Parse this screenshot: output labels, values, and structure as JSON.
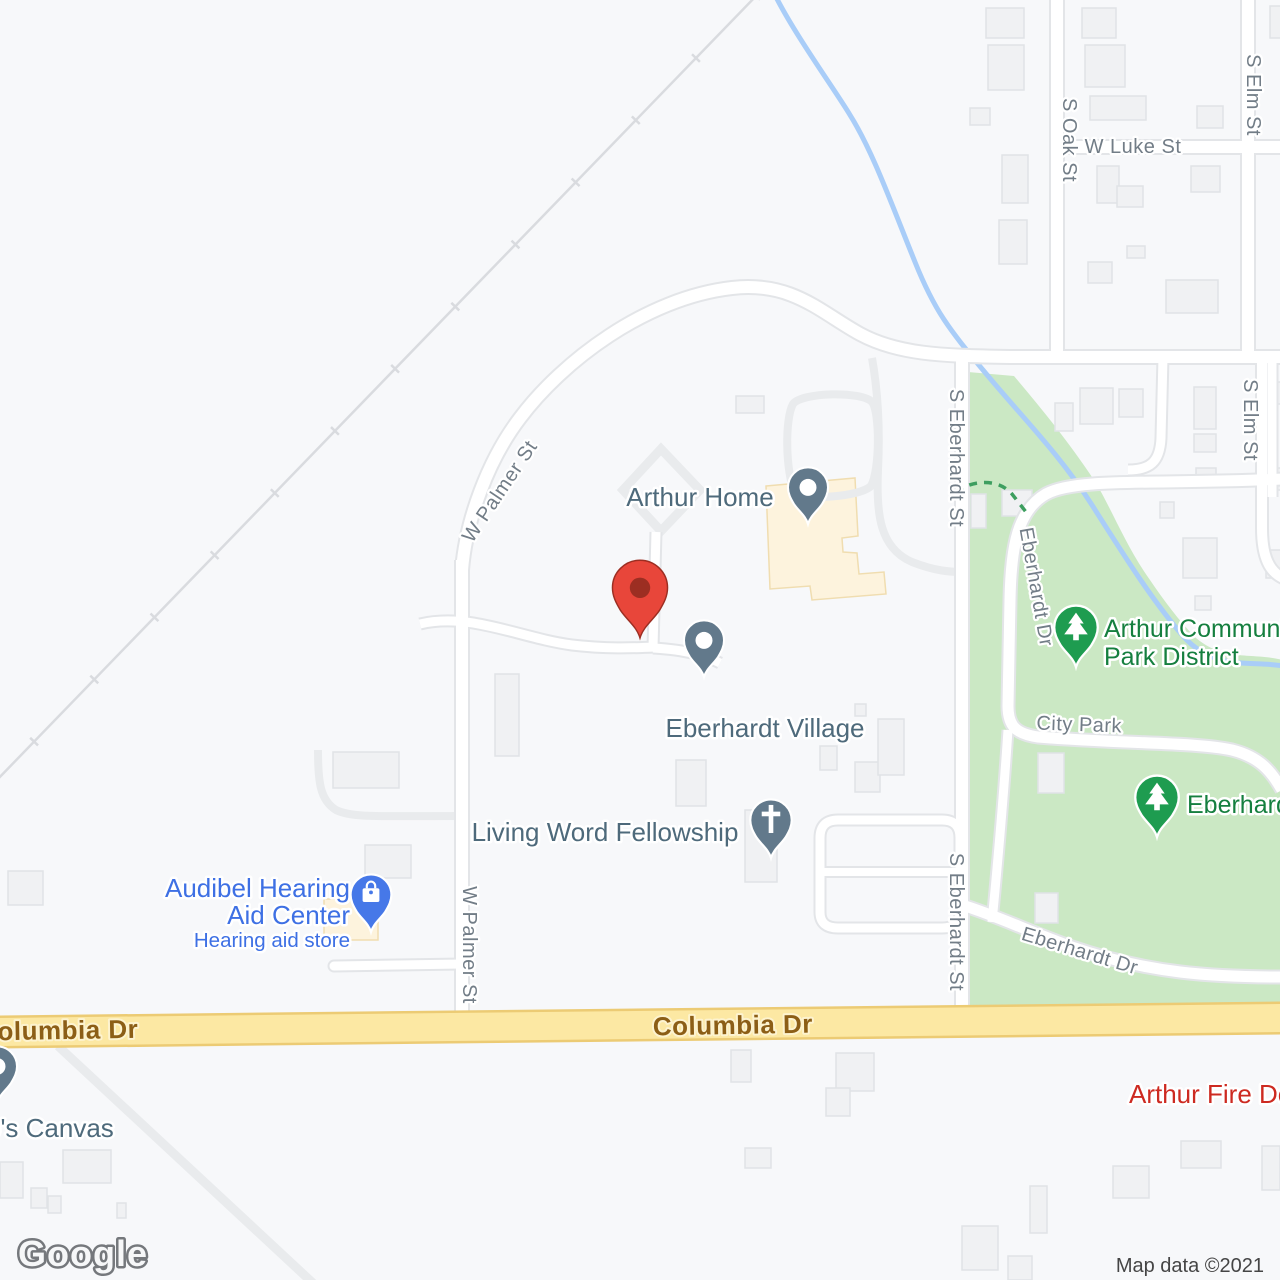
{
  "app": "google-maps-static-view",
  "attribution": {
    "logo": "Google",
    "map_data": "Map data ©2021"
  },
  "colors": {
    "background": "#f7f8fa",
    "road_fill": "#ffffff",
    "road_casing": "#e3e5e8",
    "driveway": "#e9ebed",
    "park": "#cbe8c4",
    "water": "#a9cdf8",
    "railroad": "#d9dbdf",
    "building_fill": "#f0f1f3",
    "building_stroke": "#e0e3e6",
    "commercial_building": "#fdf3dd",
    "commercial_building_stroke": "#f0ddb0",
    "yellow_road_fill": "#fce8a3",
    "yellow_road_casing": "#eccb74",
    "street_label": "#727d87",
    "road_label_brown": "#8c5e16",
    "poi_slate": "#4e6a7b",
    "poi_blue": "#3e70e4",
    "poi_green": "#157f3f",
    "poi_red": "#cd2a21",
    "pin_slate": "#62798b",
    "pin_blue": "#4678e8",
    "pin_green": "#1e9c50",
    "marker_red": "#e8463a",
    "marker_red_dark": "#9c2e22",
    "attribution_text": "#454545",
    "trail_green": "#3d9e5f"
  },
  "street_labels": [
    {
      "text": "W Luke St",
      "x": 1133,
      "y": 153,
      "r": 0,
      "size": 20
    },
    {
      "text": "S Oak St",
      "x": 1063,
      "y": 140,
      "r": 90,
      "size": 20
    },
    {
      "text": "S Elm St",
      "x": 1247,
      "y": 95,
      "r": 90,
      "size": 20
    },
    {
      "text": "S Elm St",
      "x": 1244,
      "y": 420,
      "r": 90,
      "size": 20
    },
    {
      "text": "W Palmer St",
      "x": 505,
      "y": 495,
      "r": -56,
      "size": 20
    },
    {
      "text": "W Palmer St",
      "x": 463,
      "y": 945,
      "r": 90,
      "size": 20
    },
    {
      "text": "S Eberhardt St",
      "x": 950,
      "y": 458,
      "r": 90,
      "size": 20
    },
    {
      "text": "S Eberhardt St",
      "x": 950,
      "y": 922,
      "r": 90,
      "size": 20
    },
    {
      "text": "Eberhardt Dr",
      "x": 1030,
      "y": 588,
      "r": 80,
      "size": 20
    },
    {
      "text": "City Park",
      "x": 1079,
      "y": 731,
      "r": 2,
      "size": 20
    },
    {
      "text": "Eberhardt Dr",
      "x": 1078,
      "y": 957,
      "r": 17,
      "size": 20
    },
    {
      "text": "Columbia Dr",
      "x": 733,
      "y": 1034,
      "r": -1,
      "size": 26,
      "cls": "main-road-label"
    },
    {
      "text": "olumbia Dr",
      "x": 68,
      "y": 1039,
      "r": -1,
      "size": 26,
      "cls": "main-road-label"
    }
  ],
  "pois": [
    {
      "id": "arthur-home",
      "anchor": "middle",
      "color": "poi-slate",
      "lines": [
        {
          "text": "Arthur Home",
          "size": 26,
          "x": 700,
          "y": 506
        }
      ],
      "pin": {
        "x": 808,
        "y": 524,
        "type": "dot",
        "color_key": "pin_slate",
        "scale": 1.18
      }
    },
    {
      "id": "eberhardt-village",
      "anchor": "middle",
      "color": "poi-slate",
      "lines": [
        {
          "text": "Eberhardt Village",
          "size": 26,
          "x": 765,
          "y": 737
        }
      ],
      "pin": {
        "x": 704,
        "y": 677,
        "type": "dot",
        "color_key": "pin_slate",
        "scale": 1.18
      }
    },
    {
      "id": "living-word-fellowship",
      "anchor": "middle",
      "color": "poi-slate",
      "lines": [
        {
          "text": "Living Word Fellowship",
          "size": 26,
          "x": 605,
          "y": 841
        }
      ],
      "pin": {
        "x": 771,
        "y": 858,
        "type": "cross",
        "color_key": "pin_slate",
        "scale": 1.22
      }
    },
    {
      "id": "audibel-hearing-aid-center",
      "anchor": "end",
      "color": "poi-blue",
      "lines": [
        {
          "text": "Audibel Hearing",
          "size": 26,
          "x": 350,
          "y": 897
        },
        {
          "text": "Aid Center",
          "size": 26,
          "x": 350,
          "y": 924
        },
        {
          "text": "Hearing aid store",
          "size": 20.5,
          "x": 350,
          "y": 947
        }
      ],
      "pin": {
        "x": 371,
        "y": 932,
        "type": "bag",
        "color_key": "pin_blue",
        "scale": 1.2
      }
    },
    {
      "id": "arthur-community-park-district",
      "anchor": "start",
      "color": "poi-green",
      "lines": [
        {
          "text": "Arthur Community",
          "size": 25,
          "x": 1104,
          "y": 637
        },
        {
          "text": "Park District",
          "size": 25,
          "x": 1104,
          "y": 665
        }
      ],
      "pin": {
        "x": 1076,
        "y": 667,
        "type": "tree",
        "color_key": "pin_green",
        "scale": 1.28
      }
    },
    {
      "id": "eberhardt-park",
      "anchor": "start",
      "color": "poi-green",
      "lines": [
        {
          "text": "Eberhardt",
          "size": 25,
          "x": 1187,
          "y": 813
        }
      ],
      "pin": {
        "x": 1157,
        "y": 837,
        "type": "tree",
        "color_key": "pin_green",
        "scale": 1.28
      }
    },
    {
      "id": "canvas-store",
      "anchor": "start",
      "color": "poi-slate",
      "lines": [
        {
          "text": "o's Canvas",
          "size": 26,
          "x": -14,
          "y": 1137
        }
      ],
      "pin": {
        "x": -3,
        "y": 1103,
        "type": "dot",
        "color_key": "pin_slate",
        "scale": 1.18
      }
    },
    {
      "id": "arthur-fire-dept",
      "anchor": "start",
      "color": "poi-red",
      "lines": [
        {
          "text": "Arthur Fire Dept",
          "size": 26,
          "x": 1129,
          "y": 1103
        }
      ]
    }
  ],
  "marker": {
    "name": "selected-location-marker",
    "x": 640,
    "y": 638,
    "scale": 1.62
  },
  "buildings": [
    [
      986,
      8,
      38,
      30
    ],
    [
      1082,
      8,
      34,
      30
    ],
    [
      988,
      45,
      36,
      45
    ],
    [
      1085,
      45,
      40,
      42
    ],
    [
      970,
      108,
      20,
      17
    ],
    [
      1090,
      96,
      56,
      24
    ],
    [
      1197,
      106,
      26,
      22
    ],
    [
      1002,
      155,
      26,
      48
    ],
    [
      1097,
      166,
      22,
      37
    ],
    [
      1117,
      186,
      26,
      21
    ],
    [
      1191,
      166,
      29,
      26
    ],
    [
      999,
      220,
      28,
      44
    ],
    [
      1127,
      246,
      18,
      12
    ],
    [
      1088,
      262,
      24,
      21
    ],
    [
      1166,
      280,
      52,
      33
    ],
    [
      1270,
      6,
      12,
      32
    ],
    [
      1055,
      403,
      18,
      28
    ],
    [
      1080,
      388,
      33,
      36
    ],
    [
      1119,
      389,
      24,
      28
    ],
    [
      1194,
      387,
      22,
      42
    ],
    [
      1194,
      434,
      22,
      18
    ],
    [
      1196,
      468,
      20,
      19
    ],
    [
      1160,
      502,
      14,
      16
    ],
    [
      1183,
      538,
      34,
      40
    ],
    [
      1195,
      596,
      16,
      14
    ],
    [
      1273,
      382,
      8,
      22
    ],
    [
      1273,
      468,
      8,
      22
    ],
    [
      1266,
      550,
      16,
      28
    ],
    [
      971,
      494,
      15,
      34
    ],
    [
      1002,
      490,
      30,
      26
    ],
    [
      1038,
      753,
      26,
      40
    ],
    [
      1035,
      893,
      23,
      30
    ],
    [
      736,
      396,
      28,
      17
    ],
    [
      495,
      674,
      24,
      82
    ],
    [
      676,
      760,
      30,
      46
    ],
    [
      745,
      810,
      32,
      72
    ],
    [
      820,
      746,
      17,
      24
    ],
    [
      855,
      762,
      25,
      30
    ],
    [
      878,
      719,
      26,
      56
    ],
    [
      855,
      704,
      11,
      12
    ],
    [
      333,
      752,
      66,
      36
    ],
    [
      365,
      845,
      46,
      33
    ],
    [
      8,
      871,
      35,
      34
    ],
    [
      63,
      1150,
      48,
      33
    ],
    [
      0,
      1162,
      23,
      36
    ],
    [
      31,
      1188,
      16,
      20
    ],
    [
      48,
      1196,
      13,
      17
    ],
    [
      117,
      1203,
      9,
      15
    ],
    [
      731,
      1050,
      20,
      32
    ],
    [
      836,
      1053,
      38,
      38
    ],
    [
      826,
      1088,
      24,
      28
    ],
    [
      745,
      1148,
      26,
      20
    ],
    [
      1113,
      1166,
      36,
      32
    ],
    [
      1181,
      1141,
      40,
      27
    ],
    [
      1262,
      1146,
      18,
      44
    ],
    [
      1030,
      1186,
      17,
      47
    ],
    [
      962,
      1226,
      36,
      44
    ],
    [
      1008,
      1256,
      24,
      24
    ]
  ]
}
